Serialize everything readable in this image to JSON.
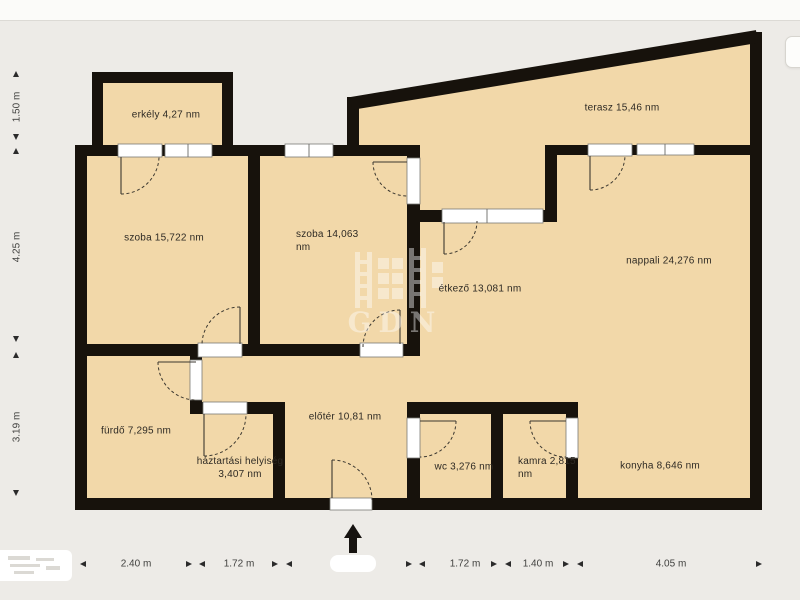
{
  "plan_title": "apartment floor plan",
  "watermark": {
    "text": "GDN"
  },
  "colors": {
    "room_fill": "#f2d8a9",
    "wall": "#17120c",
    "background": "#edebe7"
  },
  "rooms": {
    "erkely": {
      "name": "erkély",
      "area": "4,27 nm",
      "label": "erkély 4,27 nm"
    },
    "szoba1": {
      "name": "szoba",
      "area": "15,722 nm",
      "label": "szoba 15,722 nm"
    },
    "szoba2": {
      "name": "szoba",
      "area": "14,063 nm",
      "label": "szoba 14,063 nm"
    },
    "terasz": {
      "name": "terasz",
      "area": "15,46 nm",
      "label": "terasz 15,46 nm"
    },
    "etkezo": {
      "name": "étkező",
      "area": "13,081 nm",
      "label": "étkező 13,081 nm"
    },
    "nappali": {
      "name": "nappali",
      "area": "24,276 nm",
      "label": "nappali 24,276 nm"
    },
    "furdo": {
      "name": "fürdő",
      "area": "7,295 nm",
      "label": "fürdő 7,295 nm"
    },
    "haztartasi": {
      "name": "háztartási helyiség",
      "area": "3,407 nm",
      "label": "háztartási helyiség 3,407 nm"
    },
    "eloter": {
      "name": "előtér",
      "area": "10,81 nm",
      "label": "előtér 10,81 nm"
    },
    "wc": {
      "name": "wc",
      "area": "3,276 nm",
      "label": "wc 3,276 nm"
    },
    "kamra": {
      "name": "kamra",
      "area": "2,815 nm",
      "label": "kamra 2,815 nm"
    },
    "konyha": {
      "name": "konyha",
      "area": "8,646 nm",
      "label": "konyha 8,646 nm"
    }
  },
  "dimensions": {
    "left": [
      {
        "label": "1.50 m"
      },
      {
        "label": "4.25 m"
      },
      {
        "label": "3.19 m"
      }
    ],
    "bottom": [
      {
        "label": "2.40 m"
      },
      {
        "label": "1.72 m"
      },
      {
        "label": "1.72 m"
      },
      {
        "label": "1.40 m"
      },
      {
        "label": "4.05 m"
      }
    ]
  }
}
